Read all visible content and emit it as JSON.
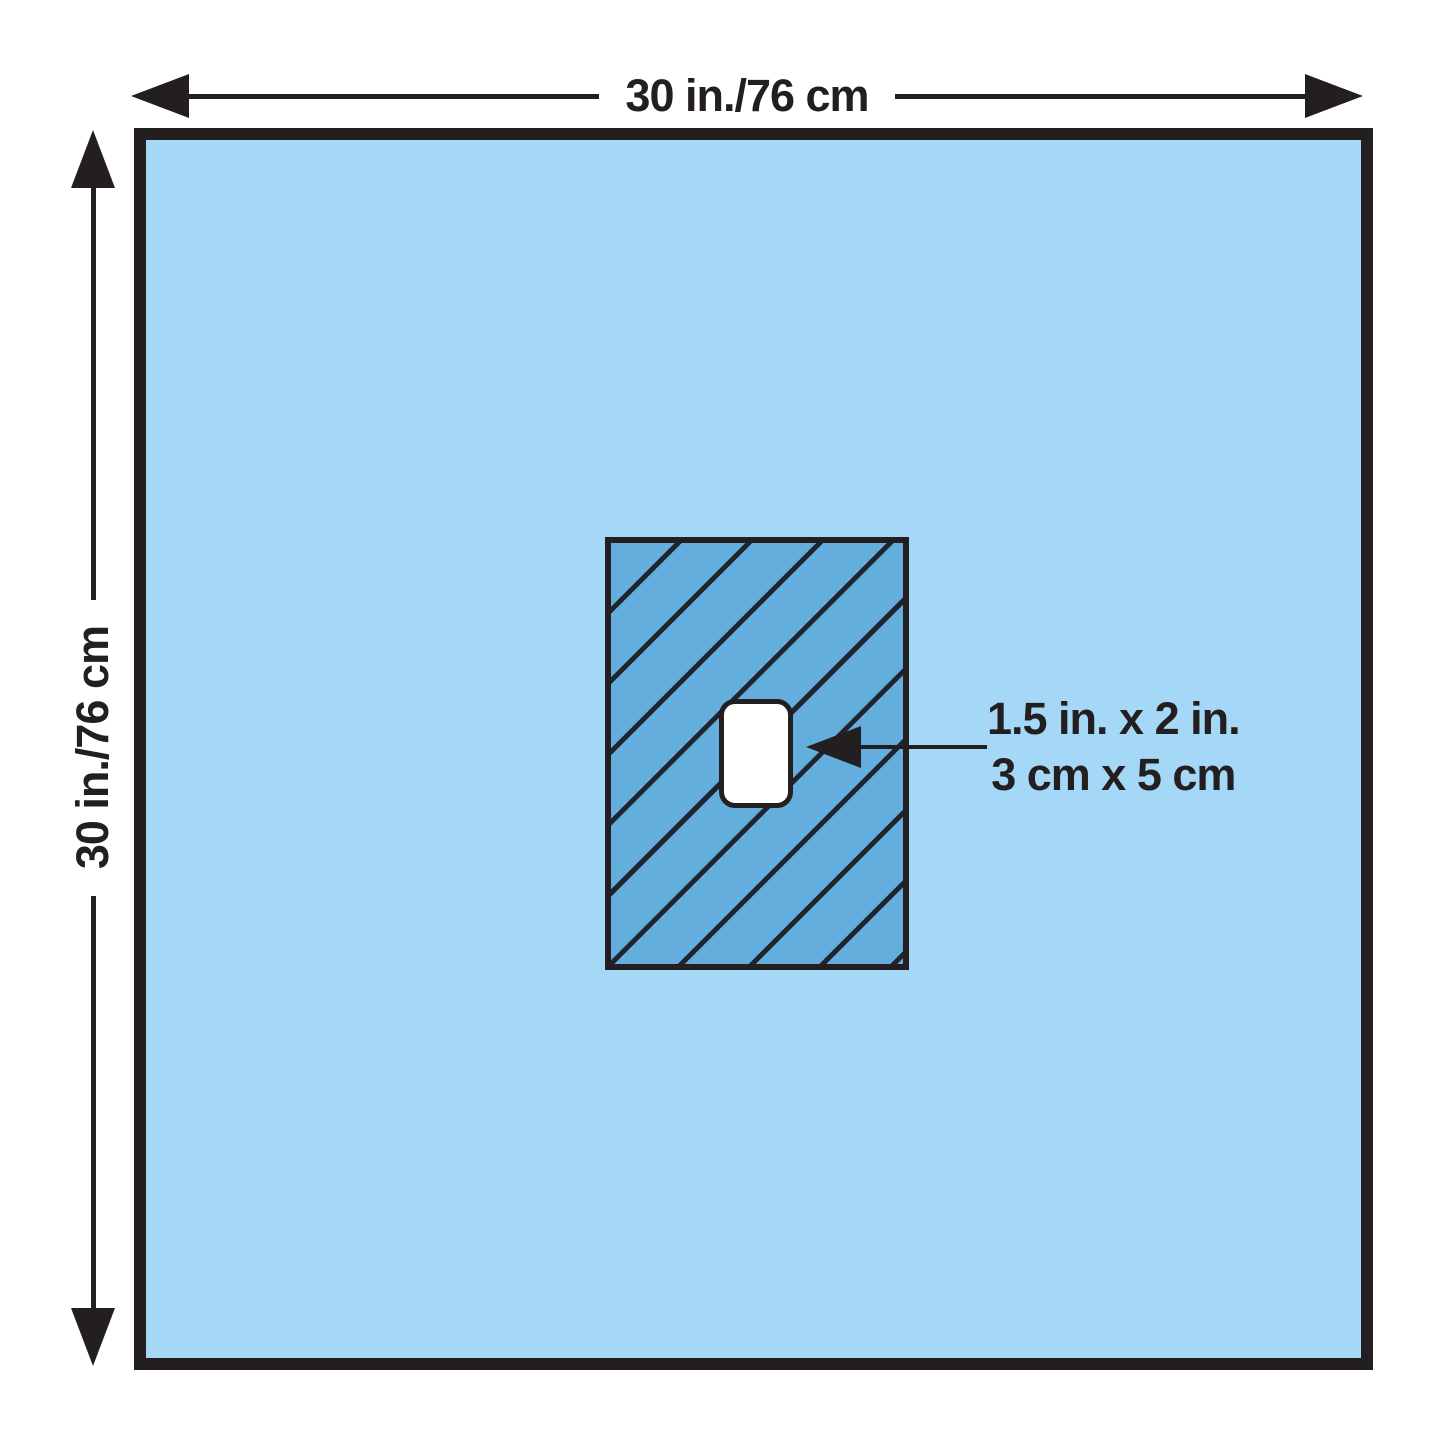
{
  "diagram": {
    "width_label": "30 in./76 cm",
    "height_label": "30 in./76 cm",
    "fenestration_label": {
      "line1": "1.5 in. x 2 in.",
      "line2": "3 cm x 5 cm"
    },
    "colors": {
      "outline": "#231f20",
      "drape_fill": "#a5d8f6",
      "reinforcement_fill": "#63aedd",
      "hatch_line": "#20242e",
      "fenestration_fill": "#ffffff",
      "page_bg": "#ffffff"
    }
  }
}
